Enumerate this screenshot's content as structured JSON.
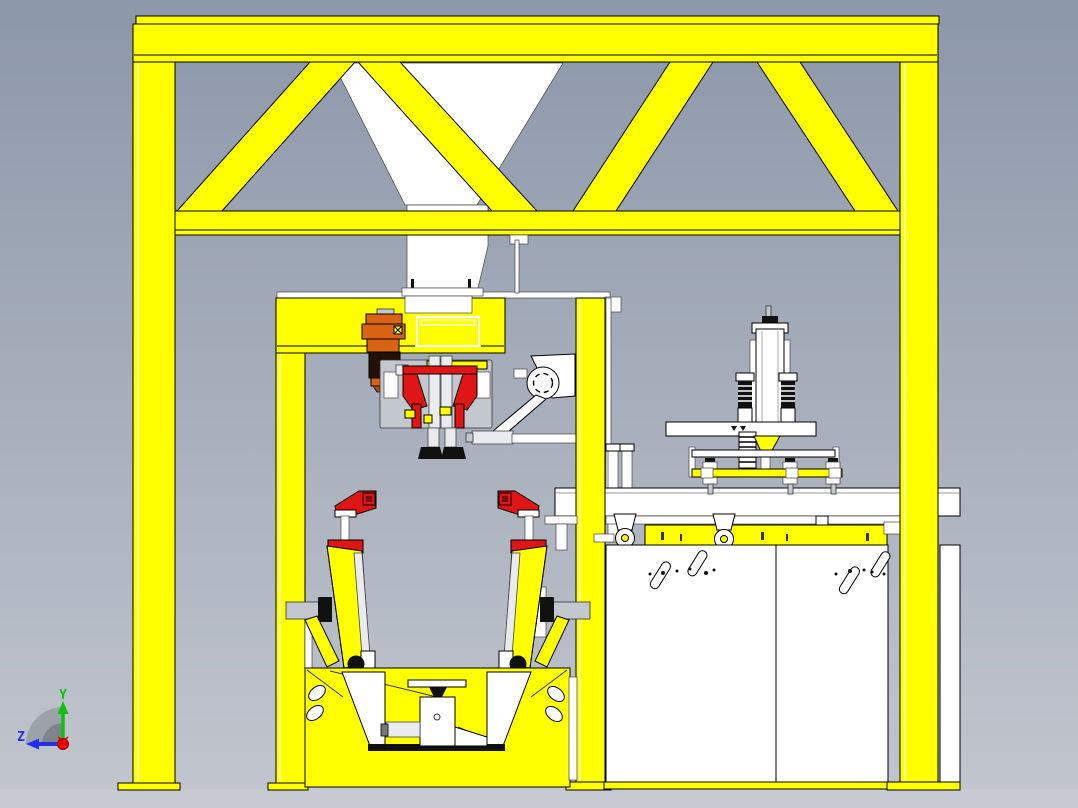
{
  "viewport": {
    "triad": {
      "y_label": "Y",
      "z_label": "Z"
    }
  },
  "colors": {
    "bg_top": "#8c97a9",
    "bg_bottom": "#c2c6ce",
    "floor": "#c7cad2",
    "yellow": "#ffff00",
    "yellow_hl": "#ffffa0",
    "white": "#ffffff",
    "light_gray": "#e9ebee",
    "steel": "#c3c8ce",
    "red": "#e01616",
    "red_dark": "#7a0c0c",
    "orange": "#d96312",
    "orange_dark": "#b34c08",
    "motor_black": "#221104",
    "dark": "#111111",
    "axis_green": "#0bc40b",
    "axis_blue": "#2330e8",
    "axis_red": "#ee0000",
    "fan_outer": "#9ba2aa",
    "fan_inner": "#7d848c"
  }
}
